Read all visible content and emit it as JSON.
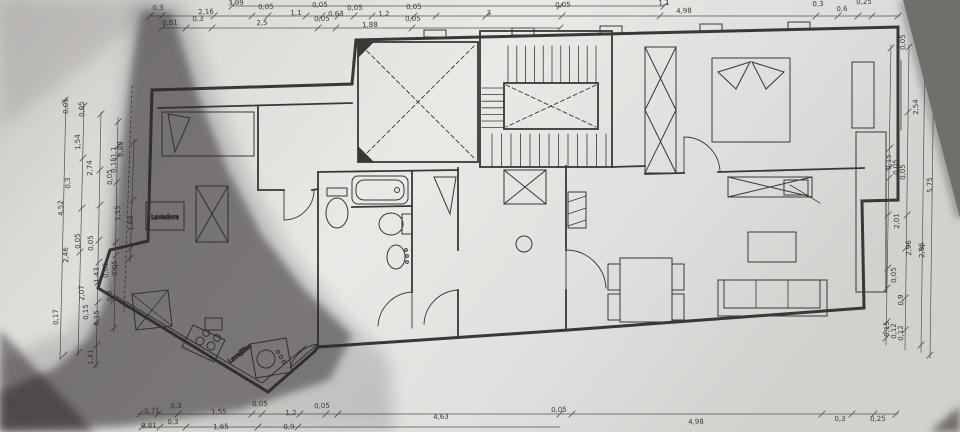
{
  "photo": {
    "paper_color": "#eae9e6",
    "paper_edge_color": "#716f6c",
    "shadow_color": "#2e2b29",
    "ink_color": "#3a3836"
  },
  "plan": {
    "room_labels": [
      {
        "text": "Lavadora"
      },
      {
        "text": "Lavajillas"
      }
    ],
    "dimensions": [
      {
        "t": "3,99",
        "x": 236,
        "y": 5
      },
      {
        "t": "1,1",
        "x": 664,
        "y": 5
      },
      {
        "t": "0,3",
        "x": 158,
        "y": 10
      },
      {
        "t": "2,16",
        "x": 206,
        "y": 14
      },
      {
        "t": "0,05",
        "x": 266,
        "y": 9
      },
      {
        "t": "1,1",
        "x": 296,
        "y": 15
      },
      {
        "t": "0,05",
        "x": 320,
        "y": 7
      },
      {
        "t": "0,63",
        "x": 336,
        "y": 16
      },
      {
        "t": "0,05",
        "x": 355,
        "y": 10
      },
      {
        "t": "1,2",
        "x": 384,
        "y": 16
      },
      {
        "t": "0,05",
        "x": 414,
        "y": 9
      },
      {
        "t": "3",
        "x": 489,
        "y": 15
      },
      {
        "t": "0,05",
        "x": 563,
        "y": 7
      },
      {
        "t": "4,98",
        "x": 684,
        "y": 13
      },
      {
        "t": "0,3",
        "x": 818,
        "y": 6
      },
      {
        "t": "0,6",
        "x": 842,
        "y": 11
      },
      {
        "t": "0,25",
        "x": 864,
        "y": 4
      },
      {
        "t": "0,81",
        "x": 170,
        "y": 25
      },
      {
        "t": "0,3",
        "x": 198,
        "y": 21
      },
      {
        "t": "2,5",
        "x": 262,
        "y": 25
      },
      {
        "t": "0,05",
        "x": 322,
        "y": 21
      },
      {
        "t": "1,88",
        "x": 370,
        "y": 27
      },
      {
        "t": "0,05",
        "x": 413,
        "y": 21
      },
      {
        "t": "0,71",
        "x": 152,
        "y": 413
      },
      {
        "t": "0,3",
        "x": 176,
        "y": 408
      },
      {
        "t": "1,55",
        "x": 219,
        "y": 414
      },
      {
        "t": "0,05",
        "x": 260,
        "y": 406
      },
      {
        "t": "1,2",
        "x": 291,
        "y": 415
      },
      {
        "t": "0,05",
        "x": 322,
        "y": 408
      },
      {
        "t": "4,63",
        "x": 441,
        "y": 419
      },
      {
        "t": "0,05",
        "x": 559,
        "y": 412
      },
      {
        "t": "4,98",
        "x": 696,
        "y": 424
      },
      {
        "t": "0,3",
        "x": 840,
        "y": 421
      },
      {
        "t": "0,25",
        "x": 878,
        "y": 421
      },
      {
        "t": "0,81",
        "x": 149,
        "y": 428
      },
      {
        "t": "0,3",
        "x": 173,
        "y": 424
      },
      {
        "t": "1,65",
        "x": 221,
        "y": 429
      },
      {
        "t": "0,9",
        "x": 289,
        "y": 429
      },
      {
        "t": "0,05",
        "x": 68,
        "y": 106,
        "r": -90
      },
      {
        "t": "0,05",
        "x": 84,
        "y": 109,
        "r": -90
      },
      {
        "t": "1,54",
        "x": 80,
        "y": 142,
        "r": -90
      },
      {
        "t": "2,74",
        "x": 92,
        "y": 168,
        "r": -90
      },
      {
        "t": "0,3",
        "x": 70,
        "y": 183,
        "r": -90
      },
      {
        "t": "4,52",
        "x": 63,
        "y": 208,
        "r": -90
      },
      {
        "t": "1,15",
        "x": 120,
        "y": 213,
        "r": -90
      },
      {
        "t": "1,68",
        "x": 133,
        "y": 223,
        "r": -90
      },
      {
        "t": "0,15",
        "x": 116,
        "y": 165,
        "r": -90
      },
      {
        "t": "0,05",
        "x": 112,
        "y": 177,
        "r": -90
      },
      {
        "t": "1,1",
        "x": 116,
        "y": 152,
        "r": -90
      },
      {
        "t": "0,88",
        "x": 123,
        "y": 149,
        "r": -90
      },
      {
        "t": "0,05",
        "x": 80,
        "y": 241,
        "r": -90
      },
      {
        "t": "0,05",
        "x": 93,
        "y": 243,
        "r": -90
      },
      {
        "t": "2,46",
        "x": 68,
        "y": 255,
        "r": -90
      },
      {
        "t": "0,05",
        "x": 108,
        "y": 270,
        "r": -90
      },
      {
        "t": "1,43",
        "x": 99,
        "y": 275,
        "r": -90
      },
      {
        "t": "0,05",
        "x": 117,
        "y": 268,
        "r": -90
      },
      {
        "t": "2,07",
        "x": 84,
        "y": 293,
        "r": -90
      },
      {
        "t": "0,9",
        "x": 112,
        "y": 296,
        "r": -90
      },
      {
        "t": "0,15",
        "x": 88,
        "y": 312,
        "r": -90
      },
      {
        "t": "0,15",
        "x": 99,
        "y": 318,
        "r": -90
      },
      {
        "t": "0,17",
        "x": 58,
        "y": 317,
        "r": -90
      },
      {
        "t": "1,41",
        "x": 93,
        "y": 357,
        "r": -90
      },
      {
        "t": "0,05",
        "x": 905,
        "y": 42,
        "r": -90
      },
      {
        "t": "2,54",
        "x": 918,
        "y": 107,
        "r": -90
      },
      {
        "t": "0,15",
        "x": 891,
        "y": 162,
        "r": -90
      },
      {
        "t": "0,05",
        "x": 898,
        "y": 167,
        "r": -90
      },
      {
        "t": "0,05",
        "x": 905,
        "y": 172,
        "r": -90
      },
      {
        "t": "5,75",
        "x": 932,
        "y": 185,
        "r": -90
      },
      {
        "t": "2,01",
        "x": 899,
        "y": 221,
        "r": -90
      },
      {
        "t": "2,96",
        "x": 911,
        "y": 248,
        "r": -90
      },
      {
        "t": "2,96",
        "x": 924,
        "y": 250,
        "r": -90
      },
      {
        "t": "0,05",
        "x": 896,
        "y": 275,
        "r": -90
      },
      {
        "t": "0,9",
        "x": 903,
        "y": 300,
        "r": -90
      },
      {
        "t": "0,15",
        "x": 889,
        "y": 329,
        "r": -90
      },
      {
        "t": "0,12",
        "x": 896,
        "y": 331,
        "r": -90
      },
      {
        "t": "0,12",
        "x": 903,
        "y": 333,
        "r": -90
      }
    ]
  }
}
